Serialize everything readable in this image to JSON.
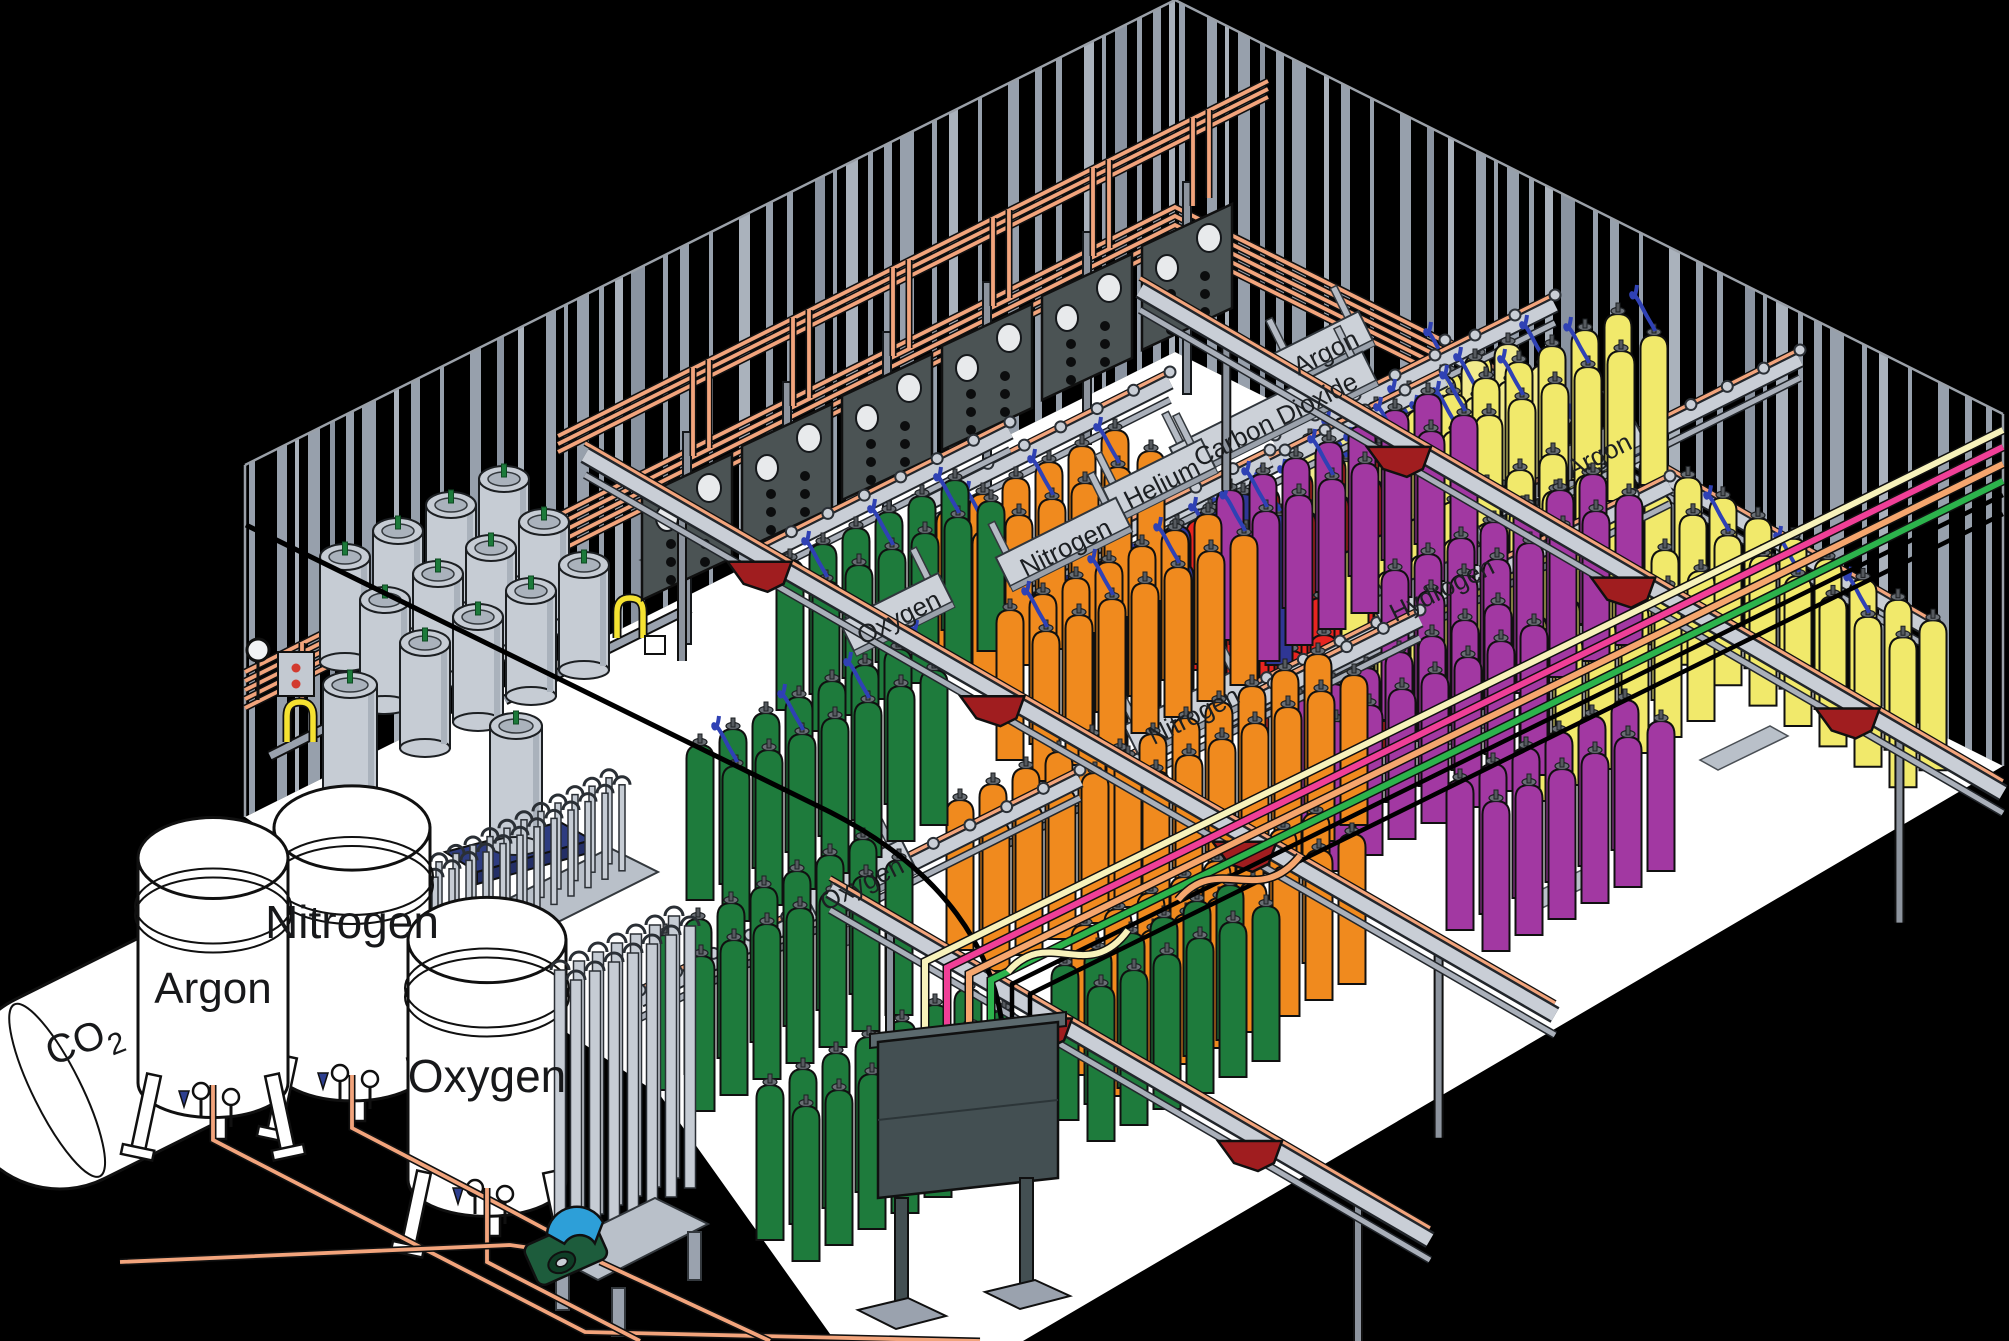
{
  "scene": {
    "type": "isometric-illustration",
    "subject": "Industrial gas cylinder filling plant",
    "colors": {
      "background": "#000000",
      "floor": "#ffffff",
      "wall_stripe": "#97a0ac",
      "wall_stripe_light": "#aab2bc",
      "wall_stripe_dark": "#8a93a0",
      "copper_pipe": "#f2a47c",
      "rail_gray": "#c9ced6",
      "beam_gray": "#aab0ba",
      "panel_gray": "#4b5354",
      "trolley_red": "#a01d1f",
      "hose_blue": "#2f41b4",
      "hose_yellow": "#f5e231",
      "scale_blue": "#2e3c80",
      "pump_green": "#1d5c3c",
      "pump_hood_blue": "#2d9fd8",
      "dewar_gray": "#c6ccd4"
    }
  },
  "bulk_storage": {
    "co2_tank_label": {
      "main": "CO",
      "sub": "2"
    },
    "cryogenic_tanks": [
      {
        "label": "Argon"
      },
      {
        "label": "Nitrogen"
      },
      {
        "label": "Oxygen"
      }
    ]
  },
  "fill_manifold_labels": {
    "back_row": [
      "Oxygen",
      "Nitrogen",
      "Helium",
      "Carbon Dioxide",
      "Argon"
    ],
    "front_row": [
      "Oxygen",
      "Nitrogen",
      "Hydrogen",
      "Argon"
    ]
  },
  "cylinder_groups": [
    {
      "gas": "Oxygen",
      "color": "#1e7b3c",
      "area": "back row",
      "cylinders": 12
    },
    {
      "gas": "Nitrogen",
      "color": "#f08a1e",
      "area": "back row",
      "cylinders": 12
    },
    {
      "gas": "Nitrogen",
      "color": "#2f3694",
      "area": "back row",
      "cylinders": 14
    },
    {
      "gas": "Helium",
      "color": "#e82420",
      "area": "back row",
      "cylinders": 24
    },
    {
      "gas": "Carbon Dioxide",
      "color": "#f2eb8d",
      "area": "back row",
      "cylinders": 24
    },
    {
      "gas": "Argon",
      "color": "#f1e96b",
      "area": "right wall",
      "cylinders": 28
    },
    {
      "gas": "Oxygen",
      "color": "#1e7b3c",
      "area": "front floor",
      "cylinders": 54
    },
    {
      "gas": "Nitrogen",
      "color": "#f08a1e",
      "area": "front floor",
      "cylinders": 54
    },
    {
      "gas": "Hydrogen",
      "color": "#a238a2",
      "area": "front floor",
      "cylinders": 54
    },
    {
      "gas": "Argon",
      "color": "#f1e96b",
      "area": "front floor",
      "cylinders": 40
    }
  ],
  "overhead_supply_lines": [
    {
      "name": "cream line",
      "color": "#f7f2bb"
    },
    {
      "name": "pink line",
      "color": "#f03f97"
    },
    {
      "name": "orange line",
      "color": "#f5a66e"
    },
    {
      "name": "green line",
      "color": "#2cb34c"
    }
  ],
  "equipment": {
    "control_panels": 6,
    "fill_stations": 2,
    "portable_dewars": 14,
    "vaporizer_units": 2,
    "tube_bundle_tubes": 14,
    "overhead_trolleys": 8
  }
}
